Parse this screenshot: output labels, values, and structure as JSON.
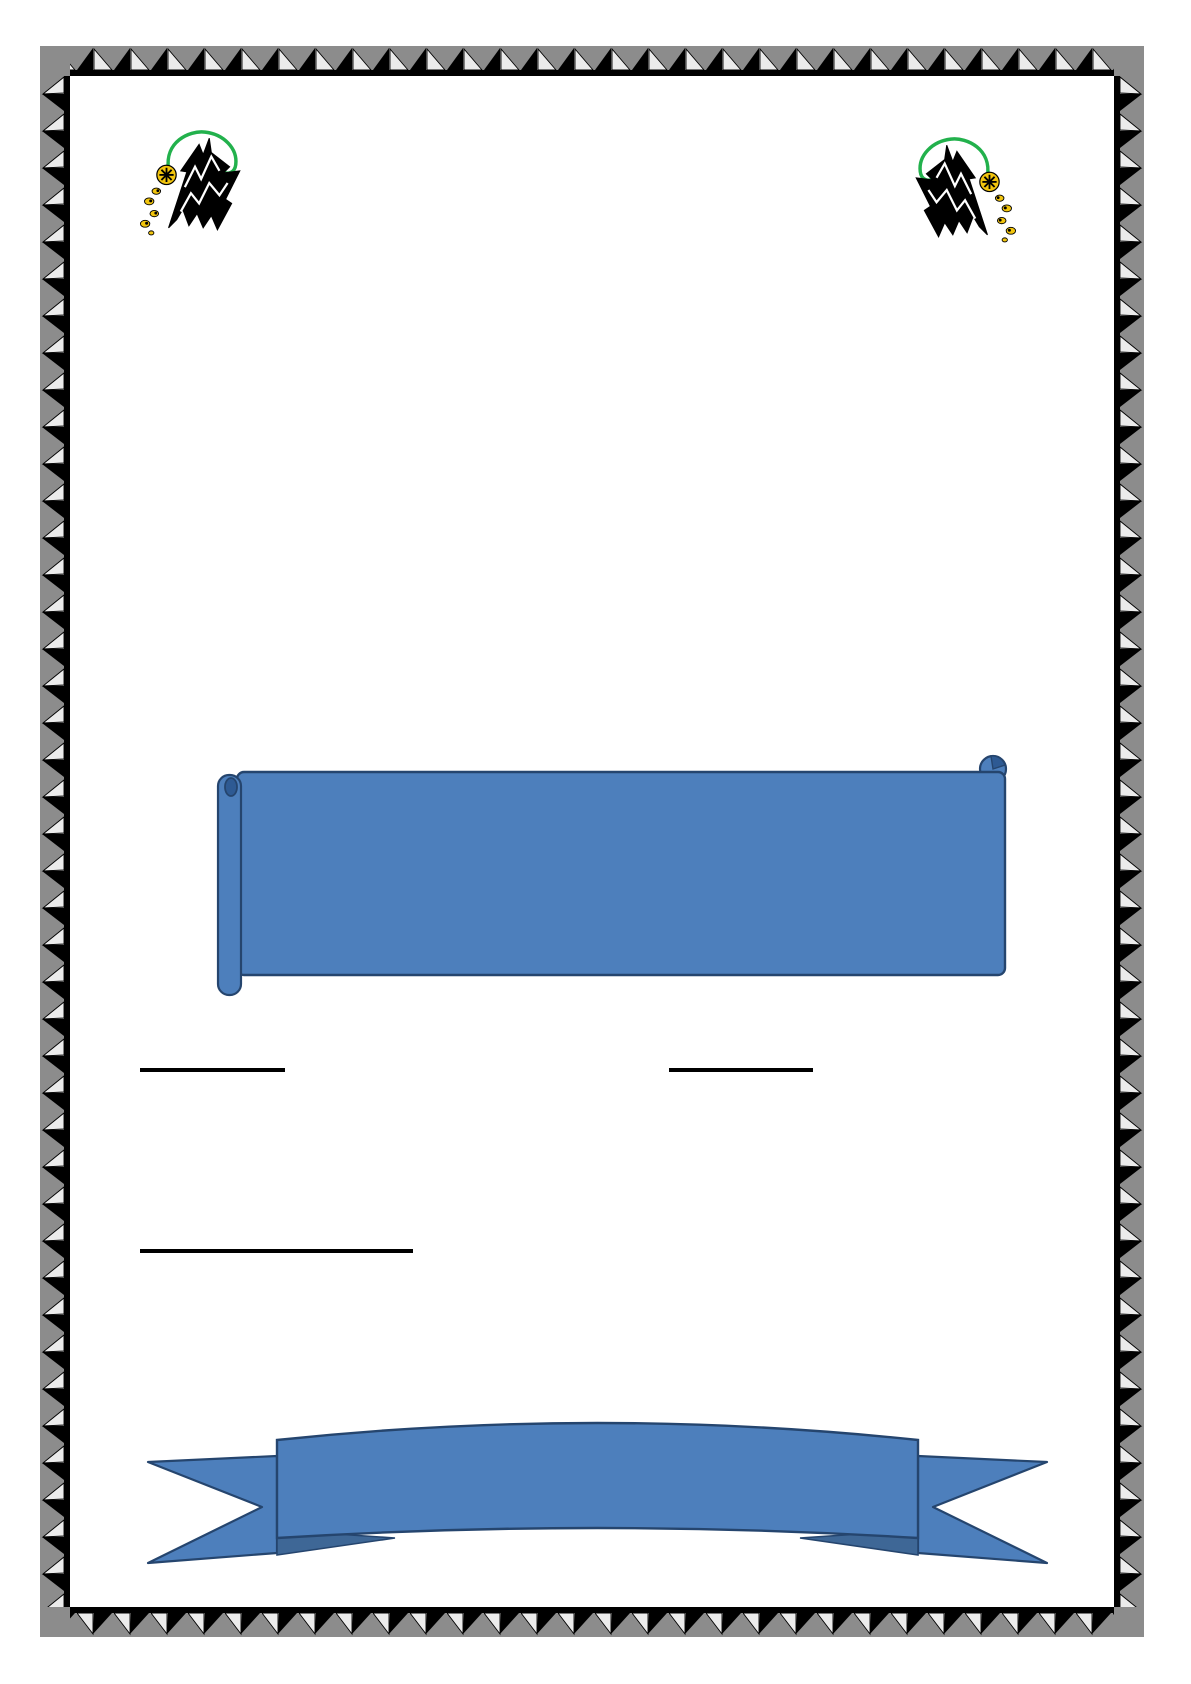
{
  "page": {
    "background": "#ffffff"
  },
  "border": {
    "style": "pyramids-art-border",
    "gray": "#8c8c8c",
    "black": "#000000",
    "light": "#ebebeb"
  },
  "logo": {
    "name": "university-mountain-crest",
    "green": "#22b14c",
    "black": "#000000",
    "yellow": "#f2c50e",
    "white": "#ffffff"
  },
  "scroll_banner": {
    "shape": "vertical-scroll",
    "fill": "#4d7fbc",
    "stroke": "#25456e",
    "shade": "#2e5a93",
    "text": ""
  },
  "underlines": {
    "color": "#000000",
    "items": [
      {
        "label": ""
      },
      {
        "label": ""
      },
      {
        "label": ""
      }
    ]
  },
  "ribbon_banner": {
    "shape": "curved-down-ribbon",
    "fill": "#4d7fbc",
    "fold": "#3e6796",
    "stroke": "#25456e",
    "text": ""
  }
}
